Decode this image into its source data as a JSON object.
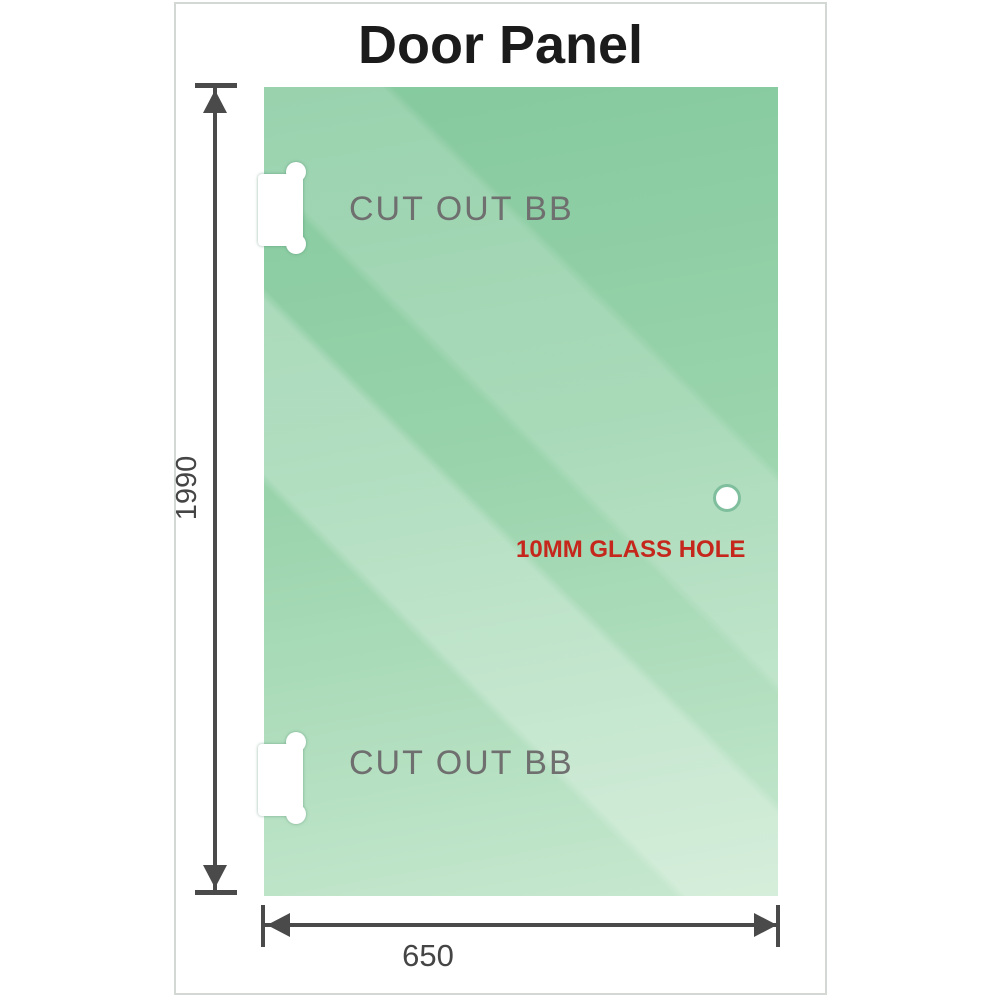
{
  "title": "Door Panel",
  "panel": {
    "cutout_top_label": "CUT OUT BB",
    "cutout_bottom_label": "CUT OUT BB",
    "hole_label": "10MM GLASS HOLE"
  },
  "dimensions": {
    "height_label": "1990",
    "width_label": "650"
  },
  "icons": {
    "cutout_top": "hinge-cutout-icon",
    "cutout_bottom": "hinge-cutout-icon",
    "hole": "glass-hole-icon",
    "height_arrows": [
      "arrow-up-icon",
      "arrow-down-icon"
    ],
    "width_arrows": [
      "arrow-left-icon",
      "arrow-right-icon"
    ]
  },
  "colors": {
    "glass_base": "#85c99e",
    "glass_light": "#c7e8cf",
    "dimension_line": "#4a4a4a",
    "cutout_text": "#6f6f6f",
    "hole_label_red": "#c5271c",
    "border": "#d3d8d5",
    "title_color": "#1b1b1b"
  }
}
